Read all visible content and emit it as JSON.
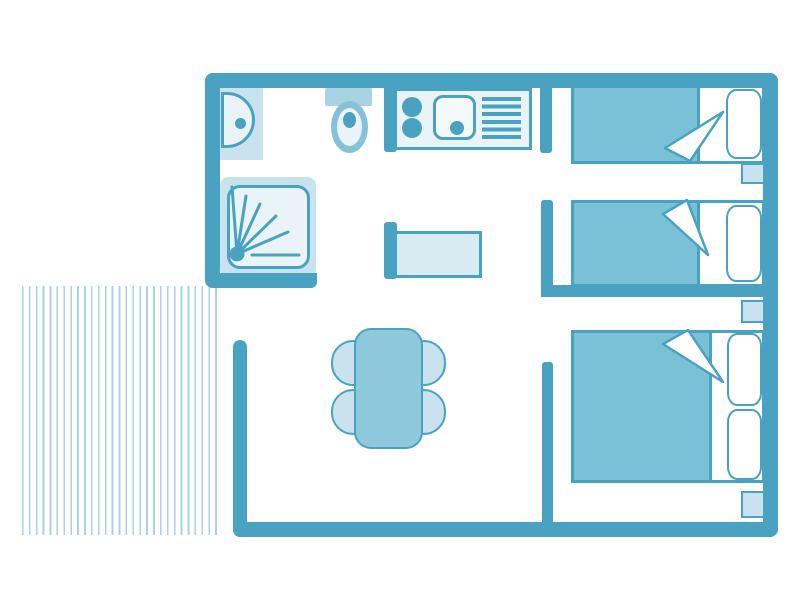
{
  "colors": {
    "wall": "#4AA2C2",
    "med": "#7AC1D7",
    "med2": "#85C2D8",
    "tbl": "#8DC8DB",
    "lightmed": "#A7D3E3",
    "light": "#C8E2EE",
    "light2": "#D8EAF2",
    "pale": "#E9F3F8",
    "stripe": "#ADD0E0"
  },
  "floor_plan": {
    "type": "mobile-home-floor-plan",
    "rooms": [
      {
        "name": "bathroom",
        "furniture": [
          "washbasin",
          "toilet",
          "shower"
        ]
      },
      {
        "name": "kitchen",
        "furniture": [
          "hob-two-burners",
          "sink",
          "drainer-rack",
          "bench-unit"
        ]
      },
      {
        "name": "living-dining-room",
        "furniture": [
          "dining-table",
          "chair",
          "chair",
          "chair",
          "chair"
        ]
      },
      {
        "name": "twin-bedroom",
        "furniture": [
          "single-bed",
          "single-bed",
          "bedside-table"
        ]
      },
      {
        "name": "double-bedroom",
        "furniture": [
          "double-bed",
          "bedside-table",
          "bedside-table"
        ]
      },
      {
        "name": "terrace",
        "furniture": [
          "decking-boards"
        ]
      }
    ]
  }
}
